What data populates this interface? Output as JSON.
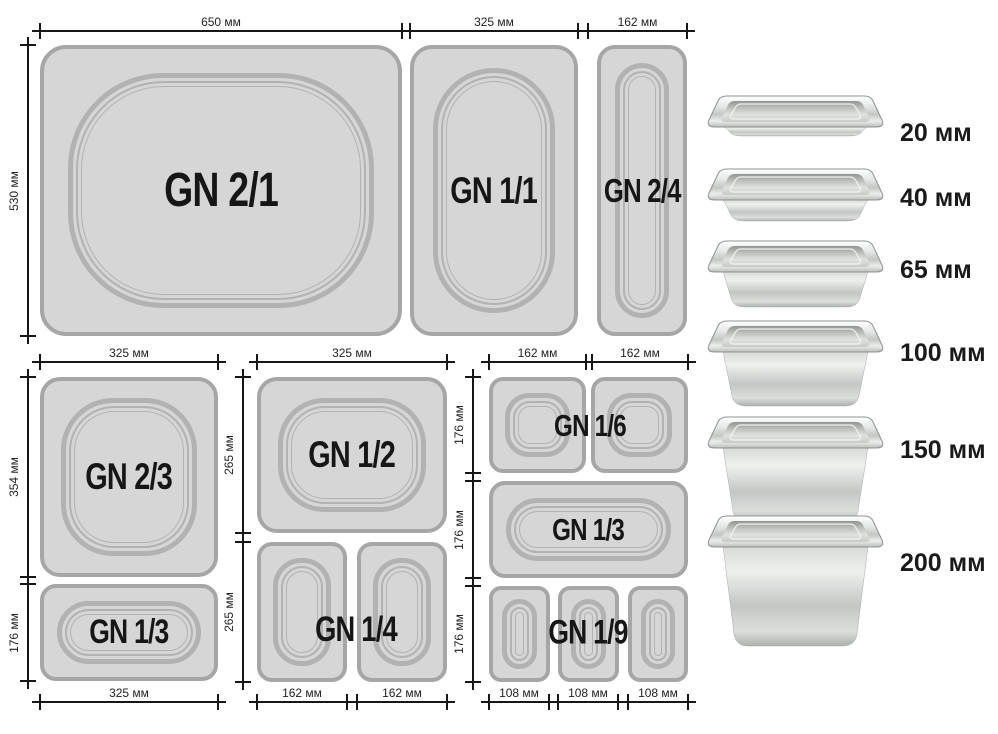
{
  "labels": {
    "gn21": "GN 2/1",
    "gn11": "GN 1/1",
    "gn24": "GN 2/4",
    "gn23": "GN 2/3",
    "gn13_left": "GN 1/3",
    "gn12": "GN 1/2",
    "gn14": "GN 1/4",
    "gn16": "GN 1/6",
    "gn13_right": "GN 1/3",
    "gn19": "GN 1/9"
  },
  "dims": {
    "top": {
      "d650": "650 мм",
      "d325": "325 мм",
      "d162": "162 мм",
      "d530": "530 мм"
    },
    "bottom_left": {
      "top325": "325 мм",
      "h354": "354 мм",
      "h176": "176 мм",
      "bottom325": "325 мм"
    },
    "bottom_middle": {
      "top325": "325 мм",
      "h265a": "265 мм",
      "h265b": "265 мм",
      "b162a": "162 мм",
      "b162b": "162 мм"
    },
    "bottom_right": {
      "t162a": "162 мм",
      "t162b": "162 мм",
      "h176a": "176 мм",
      "h176b": "176 мм",
      "h176c": "176 мм",
      "b108a": "108 мм",
      "b108b": "108 мм",
      "b108c": "108 мм"
    }
  },
  "depths": {
    "items": [
      "20 мм",
      "40 мм",
      "65 мм",
      "100 мм",
      "150 мм",
      "200 мм"
    ]
  },
  "colors": {
    "background": "#ffffff",
    "pan_fill": "#d6d6d6",
    "pan_border": "#a6a6a6",
    "inner_ring": "#b2b2b2",
    "dimension_line": "#161616",
    "label_text": "#161616"
  }
}
